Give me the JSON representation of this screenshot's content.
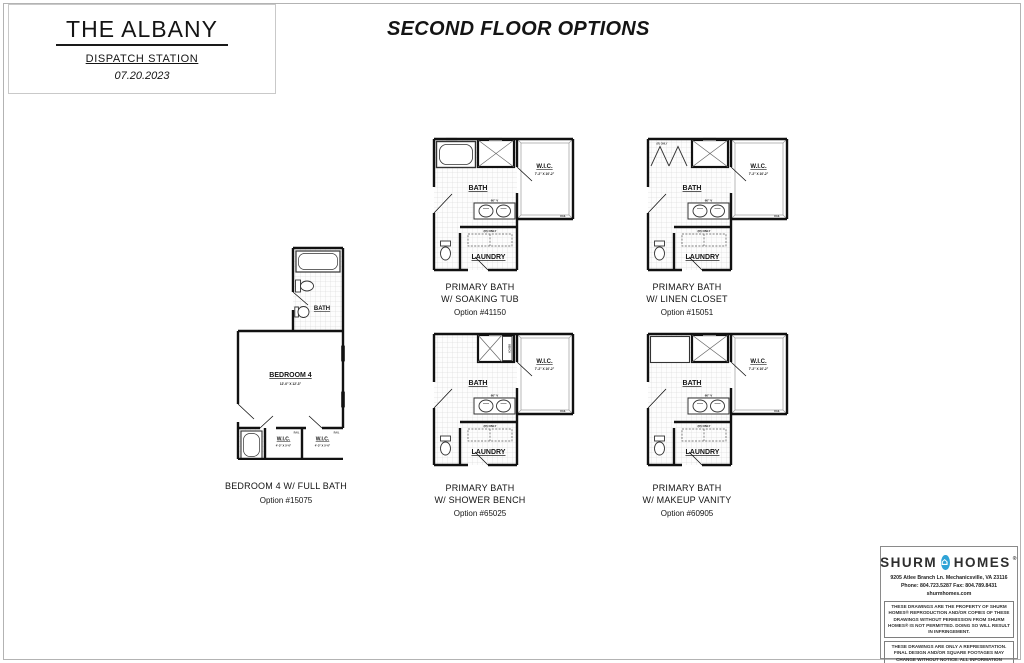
{
  "title_block": {
    "title": "THE ALBANY",
    "subtitle": "DISPATCH STATION",
    "date": "07.20.2023"
  },
  "heading": "SECOND FLOOR OPTIONS",
  "common_labels": {
    "bath": "BATH",
    "wic": "W.I.C.",
    "wic_dims": "7'-2\" X 10'-2\"",
    "laundry": "LAUNDRY",
    "laundry_note": "(R) ONLY",
    "closet_note": "(R) ONLY",
    "vanity": "60\" V",
    "bench": "BENCH",
    "rail": "RAIL"
  },
  "plans": {
    "bedroom4": {
      "name": "BEDROOM 4 W/ FULL BATH",
      "option": "Option #15075",
      "room": "BEDROOM 4",
      "room_dims": "12'-0\" X 12'-3\"",
      "wic": "W.I.C.",
      "wic1_dims": "4'-3\" X 5'-0\"",
      "wic2_dims": "4'-3\" X 5'-0\""
    },
    "soaking_tub": {
      "line1": "PRIMARY BATH",
      "line2": "W/ SOAKING TUB",
      "option": "Option #41150"
    },
    "linen_closet": {
      "line1": "PRIMARY BATH",
      "line2": "W/ LINEN CLOSET",
      "option": "Option #15051"
    },
    "shower_bench": {
      "line1": "PRIMARY BATH",
      "line2": "W/ SHOWER BENCH",
      "option": "Option #65025"
    },
    "makeup_vanity": {
      "line1": "PRIMARY BATH",
      "line2": "W/ MAKEUP VANITY",
      "option": "Option #60905"
    }
  },
  "logo_block": {
    "brand_left": "SHURM",
    "brand_right": "HOMES",
    "trademark": "®",
    "house_glyph": "⌂",
    "brand_blue": "#2fa3d6",
    "address": "9205 Atlee Branch Ln. Mechanicsville, VA 23116",
    "phone_fax": "Phone: 804.723.5287  Fax: 804.789.8431",
    "website": "shurmhomes.com",
    "disclaimer1": "THESE DRAWINGS ARE THE PROPERTY OF SHURM HOMES® REPRODUCTION AND/OR COPIES OF THESE DRAWINGS WITHOUT PERMISSION FROM SHURM HOMES® IS NOT PERMITTED. DOING SO WILL RESULT IN INFRINGEMENT.",
    "disclaimer2": "THESE DRAWINGS ARE ONLY A REPRESENTATION. FINAL DESIGN AND/OR SQUARE FOOTAGES MAY CHANGE WITHOUT NOTICE. ALL INFORMATION DEEMED RELIABLE BUT NOT GUARANTEED."
  }
}
